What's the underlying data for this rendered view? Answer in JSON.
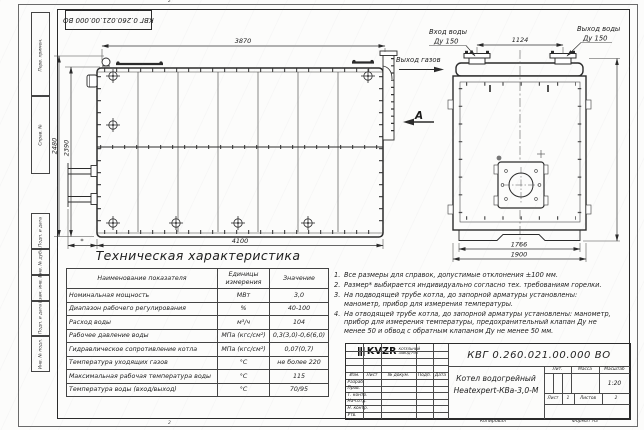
{
  "doc_number": "КВГ 0.260.021.00.000 ВО",
  "sheet": {
    "fold_mark": "2",
    "side_stamps": [
      "Перв. примен.",
      "Справ. №",
      "Подп. и дата",
      "Инв. № дубл.",
      "Взам. инв. №",
      "Подп. и дата",
      "Инв. № подл."
    ]
  },
  "main_view": {
    "dim_top": "3870",
    "dim_height_outer": "2480",
    "dim_height_inner": "2390",
    "dim_bottom": "4100",
    "dim_burner": "*",
    "gas_outlet_label": "Выход газов",
    "view_label": "А"
  },
  "end_view": {
    "inlet_line1": "Вход воды",
    "inlet_line2": "Ду 150",
    "outlet_line1": "Выход воды",
    "outlet_line2": "Ду 150",
    "dim_nozzle_spacing": "1124",
    "dim_width_inner": "1766",
    "dim_width_overall": "1900"
  },
  "table": {
    "title": "Техническая характеристика",
    "headers": [
      "Наименование показателя",
      "Единицы измерения",
      "Значение"
    ],
    "rows": [
      {
        "name": "Номинальная мощность",
        "unit": "МВт",
        "value": "3,0"
      },
      {
        "name": "Диапазон рабочего регулирования",
        "unit": "%",
        "value": "40-100"
      },
      {
        "name": "Расход воды",
        "unit": "м³/ч",
        "value": "104"
      },
      {
        "name": "Рабочее давление воды",
        "unit": "МПа (кгс/см²)",
        "value": "0,3(3,0)-0,6(6,0)"
      },
      {
        "name": "Гидравлическое сопротивление котла",
        "unit": "МПа (кгс/см²)",
        "value": "0,07(0,7)"
      },
      {
        "name": "Температура уходящих газов",
        "unit": "°С",
        "value": "не более 220"
      },
      {
        "name": "Максимальная рабочая температура воды",
        "unit": "°С",
        "value": "115"
      },
      {
        "name": "Температура воды (вход/выход)",
        "unit": "°С",
        "value": "70/95"
      }
    ]
  },
  "notes": [
    {
      "num": "1.",
      "text": "Все размеры для справок, допустимые отклонения ±100 мм."
    },
    {
      "num": "2.",
      "text": "Размер* выбирается индивидуально согласно тех. требованиям горелки."
    },
    {
      "num": "3.",
      "text": "На подводящей трубе котла, до запорной арматуры установлены: манометр, прибор для измерения температуры."
    },
    {
      "num": "4.",
      "text": "На отводящей трубе котла, до запорной арматуры установлены: манометр, прибор для измерения температуры, предохранительный клапан Ду не менее 50 и обвод с обратным клапаном Ду не менее 50 мм."
    }
  ],
  "title_block": {
    "product_name_line1": "Котел водогрейный",
    "product_name_line2": "Heatexpert-КВа-3,0-М",
    "rev_headers": [
      "Изм.",
      "Лист",
      "№ докум.",
      "Подп.",
      "Дата"
    ],
    "sign_rows": [
      "Разраб.",
      "Пров.",
      "Т. контр.",
      "Нач.отд.",
      "Н. контр.",
      "Утв."
    ],
    "lit_label": "Лит.",
    "mass_label": "Масса",
    "scale_label": "Масштаб",
    "scale_value": "1:20",
    "sheet_label": "Лист",
    "sheet_value": "1",
    "sheets_label": "Листов",
    "sheets_value": "2",
    "logo_text": "KVZR",
    "company_line1": "КОТЕЛЬНЫЙ",
    "company_line2": "ЗАВОД РЭП",
    "copied_label": "Копировал",
    "format_label": "Формат А3"
  }
}
